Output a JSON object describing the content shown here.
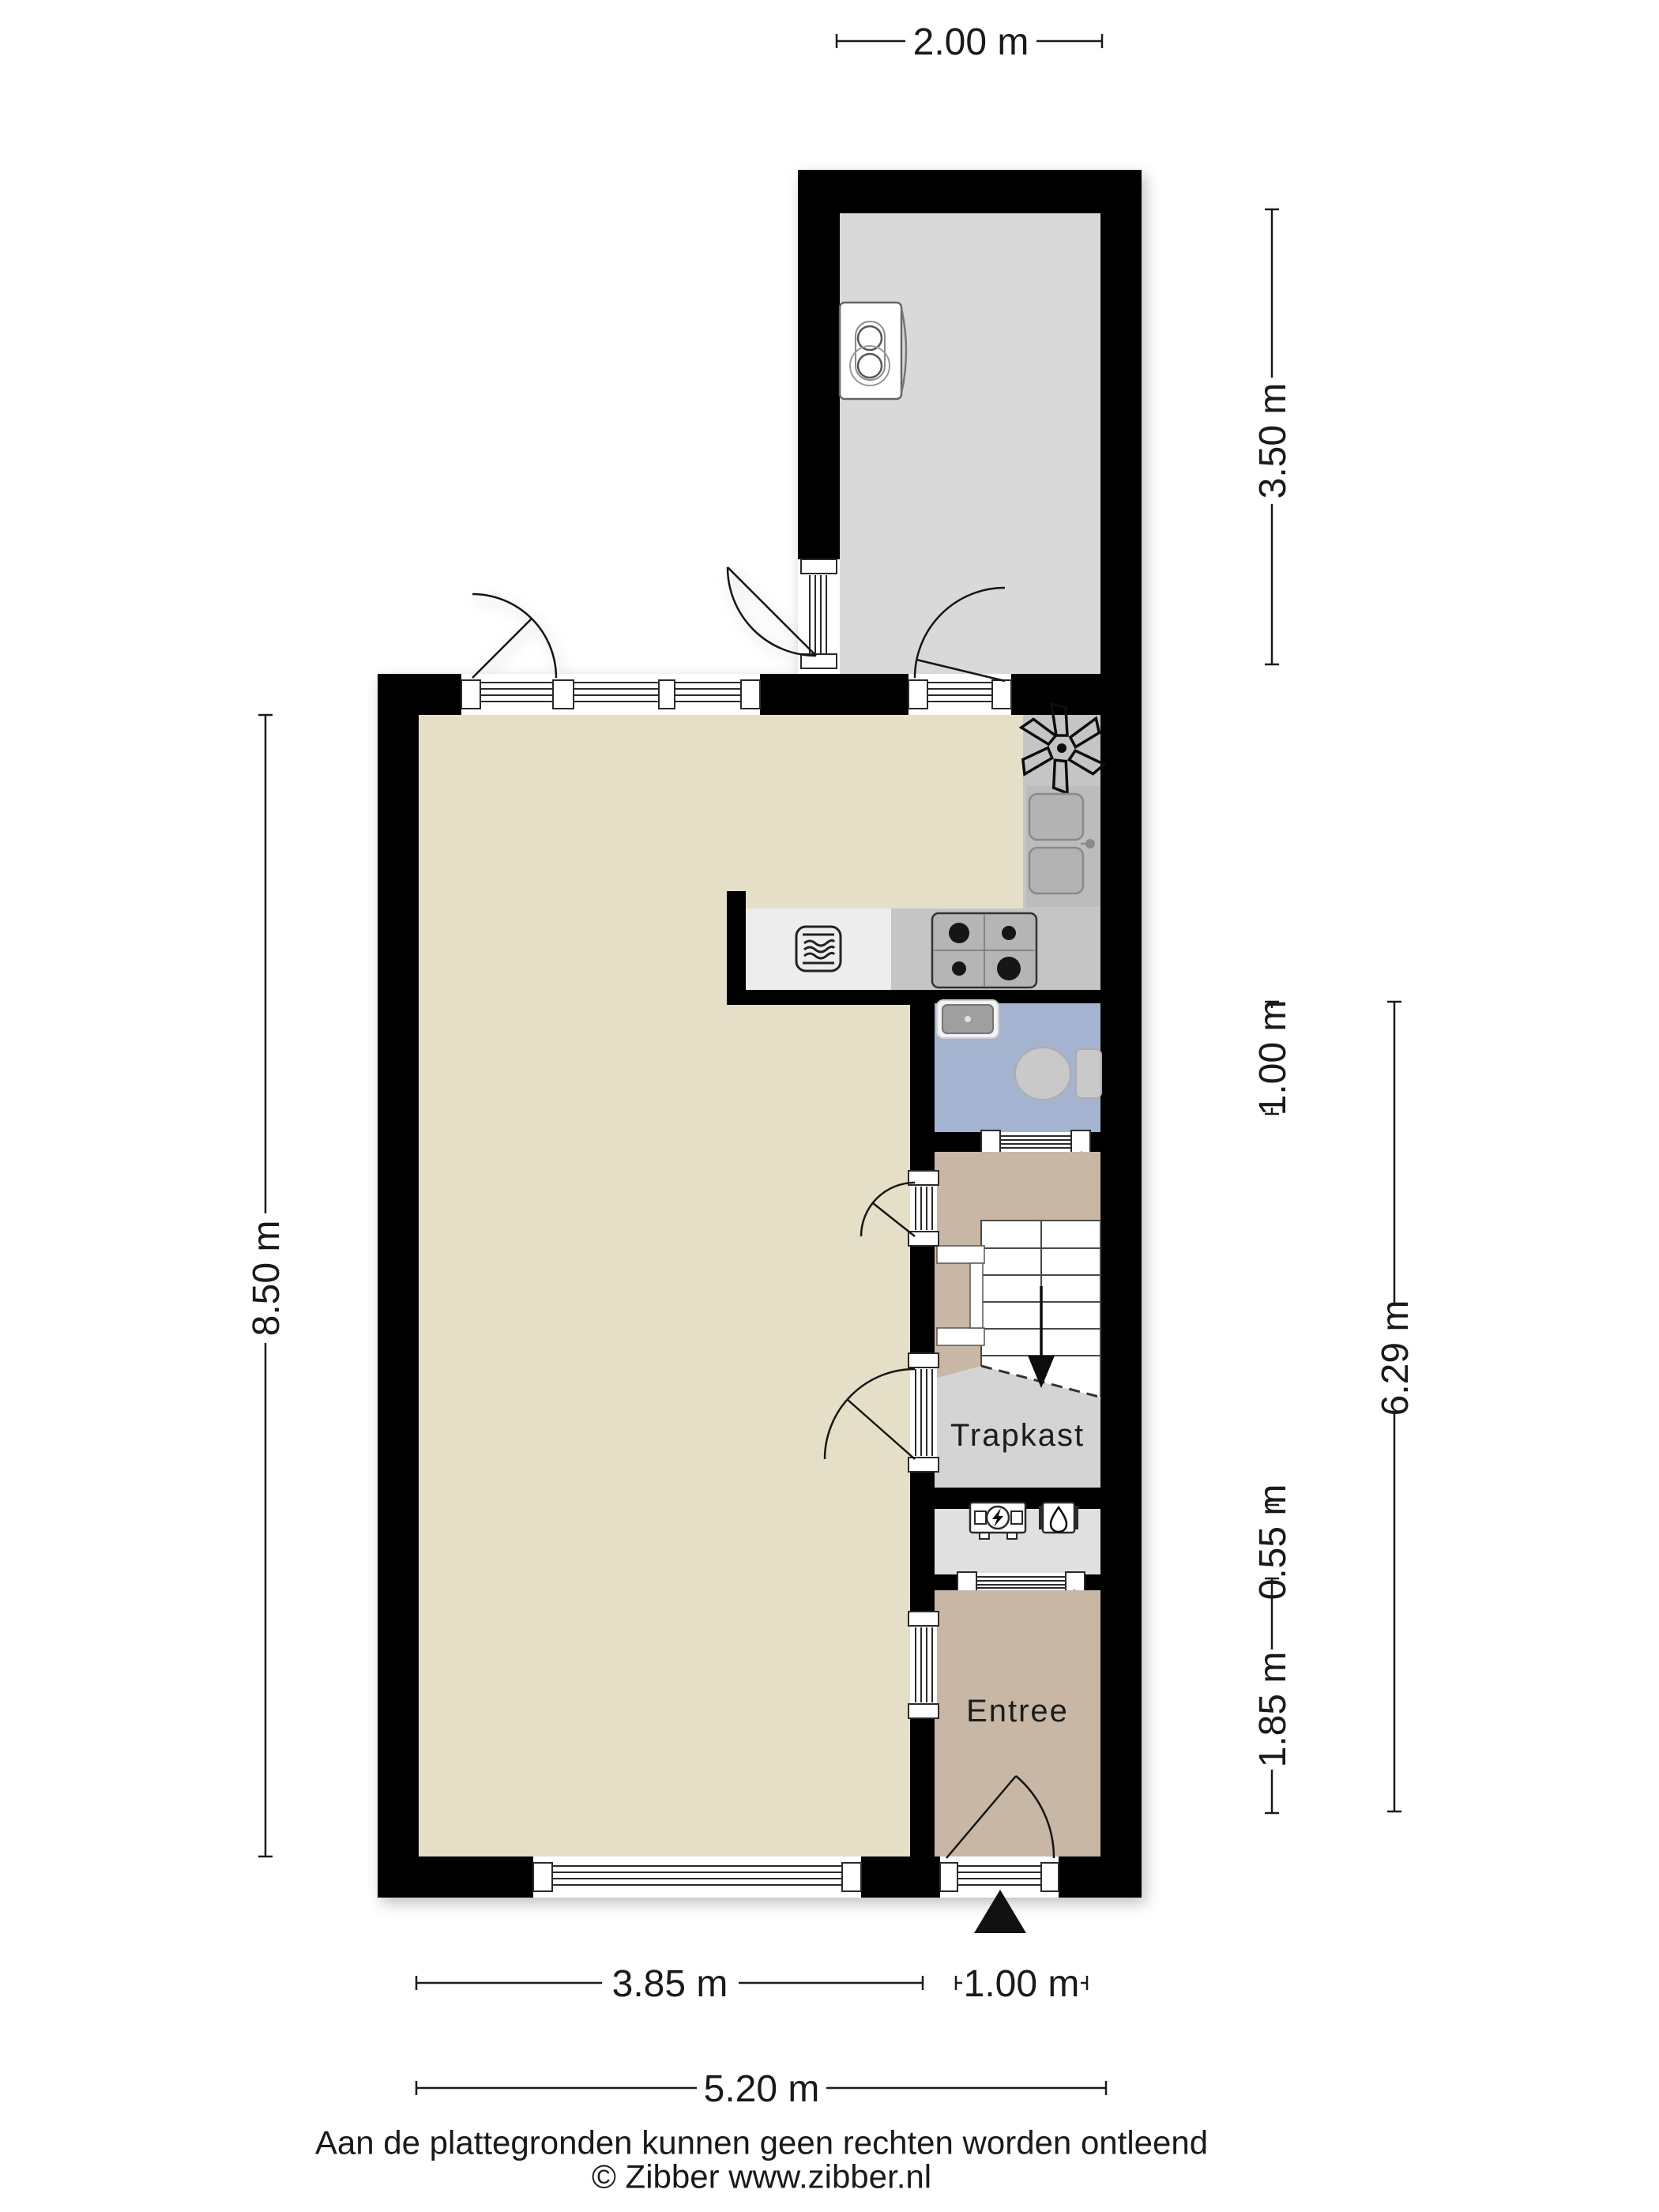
{
  "rooms": {
    "trapkast": "Trapkast",
    "entree": "Entree"
  },
  "dimensions": {
    "top_width": "2.00 m",
    "annex_height": "3.50 m",
    "left_height": "8.50 m",
    "toilet_height": "1.00 m",
    "right_total_height": "6.29 m",
    "meter_height": "0.55 m",
    "entree_height": "1.85 m",
    "living_width": "3.85 m",
    "entree_width": "1.00 m",
    "total_width": "5.20 m"
  },
  "footer": {
    "disclaimer": "Aan de plattegronden kunnen geen rechten worden ontleend",
    "copyright": "© Zibber www.zibber.nl"
  },
  "colors": {
    "wall": "#000000",
    "living_floor": "#e6dfc7",
    "annex_floor": "#d9d9d9",
    "hall_floor": "#c8b7a4",
    "toilet_floor": "#a4b3cf",
    "trapkast_floor": "#d4d4d4",
    "meter_floor": "#e0e0e0",
    "counter": "#c5c5c5"
  },
  "icons": {
    "boiler": "boiler-icon",
    "ventilation": "fan-asterisk-icon",
    "oven": "oven-icon",
    "hob": "four-burner-hob-icon",
    "sink": "double-sink-icon",
    "washbasin": "washbasin-icon",
    "toilet": "toilet-icon",
    "electric_meter": "electric-meter-icon",
    "gas_meter": "gas-meter-icon",
    "stairs_down": "stairs-down-arrow-icon",
    "entrance": "entrance-triangle-icon"
  }
}
